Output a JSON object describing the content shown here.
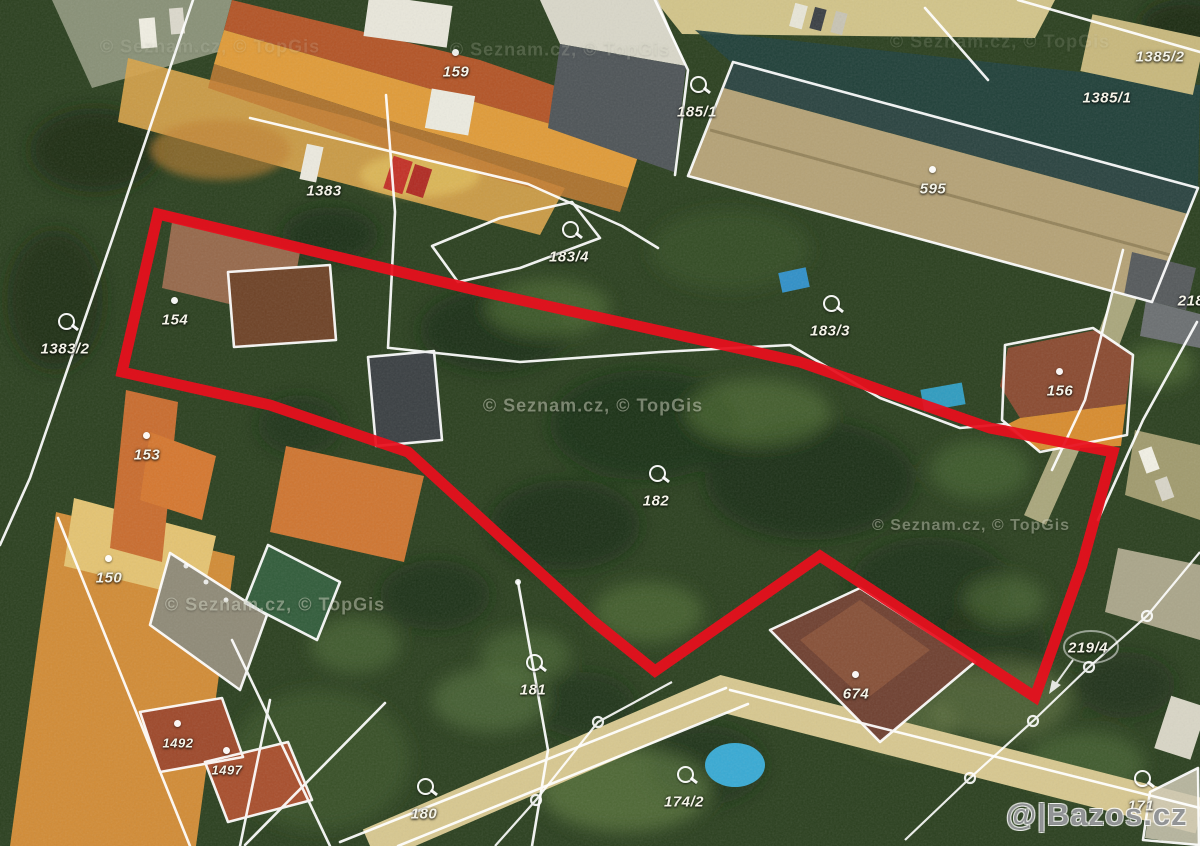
{
  "map": {
    "watermark_provider": "© Seznam.cz, © TopGis",
    "watermark_brand": "@|Bazos.cz",
    "boundary_color": "#e8101e",
    "parcel_labels": {
      "159": "159",
      "1383": "1383",
      "1385_2": "1385/2",
      "1385_1": "1385/1",
      "185_1": "185/1",
      "595": "595",
      "183_4": "183/4",
      "183_3": "183/3",
      "1383_2": "1383/2",
      "154": "154",
      "153": "153",
      "156": "156",
      "218": "218",
      "182": "182",
      "150": "150",
      "181": "181",
      "674": "674",
      "219_4": "219/4",
      "174_2": "174/2",
      "180": "180",
      "171": "171",
      "1492": "1492",
      "1497": "1497"
    }
  }
}
